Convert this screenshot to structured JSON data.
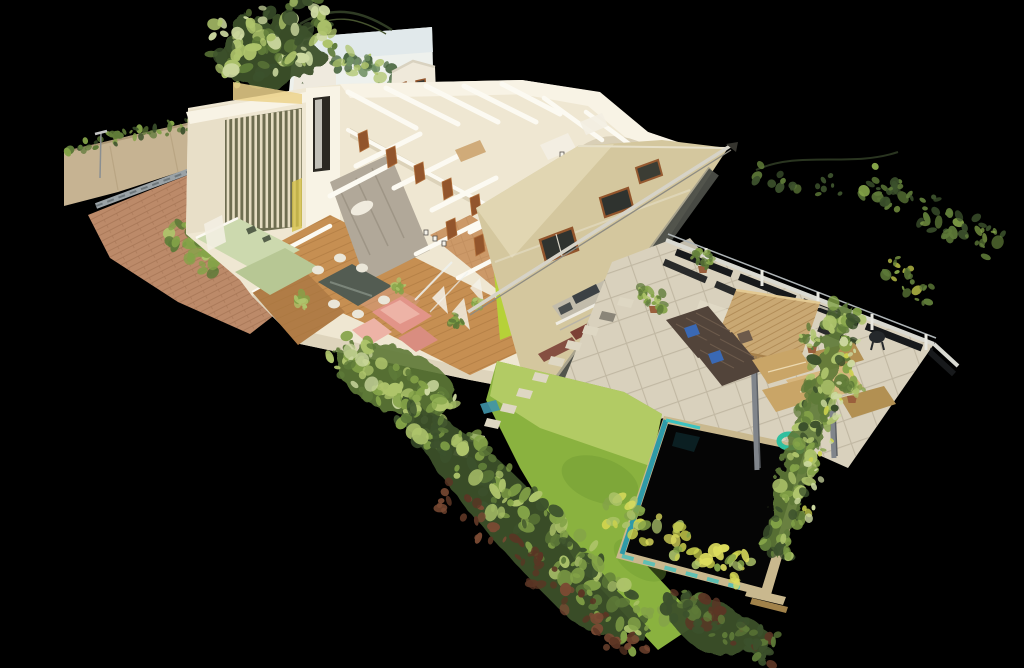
{
  "canvas": {
    "width": 1024,
    "height": 668
  },
  "scene": {
    "type": "3d-dollhouse-point-cloud-render",
    "subject": "cutaway dollhouse view of a single-story house interior with driveway, rear patio, pergola, lawn and swimming pool, surrounded by scan-noise foliage on a black void",
    "view_angle": "oblique top-down isometric"
  },
  "palette": {
    "bg": "#000000",
    "wallCream": "#efe7d2",
    "wallBright": "#f8f3e5",
    "wallShade": "#d9cfb6",
    "wallCap": "#fcfaf2",
    "wallFaceLeft": "#e8dfc8",
    "soffitWarm": "#ecd28c",
    "facadeKhaki": "#d4c79e",
    "facadeKhakiLight": "#e4dab6",
    "facadeEdgeDark": "#4c4e48",
    "facadeTrim": "#e6dfc8",
    "doorBrown": "#92552c",
    "doorBrownLight": "#b06f3a",
    "doorSlitDark": "#2b2822",
    "concreteGray": "#b1a899",
    "concreteDark": "#8e8678",
    "woodFloor": "#c68f52",
    "woodLine": "#a9763d",
    "woodDeck": "#b07c46",
    "tileHall": "#cc9968",
    "roseTile": "#d9a08a",
    "kitchenSage": "#ccd9ae",
    "kitchenSageDark": "#b7c794",
    "applianceDark": "#55604a",
    "sofaPink": "#e29488",
    "sofaPinkLight": "#edb3a6",
    "sofaPinkDeep": "#d98d80",
    "tableDark": "#535c52",
    "tableSheen": "#7b857a",
    "chairWhite": "#eae6d8",
    "limeAccent": "#b6d138",
    "limeDark": "#8fae2a",
    "curtainWhite": "#f4f2ea",
    "slatCream": "#ece2c8",
    "slatGapOlive": "#6e6d50",
    "slatYellow": "#d6c24a",
    "brickDrive": "#bc8a69",
    "brickLine": "#a06f50",
    "channelGray": "#9aa2a6",
    "channelDark": "#6e777b",
    "stoneWall": "#c6b392",
    "stoneWallShade": "#a5916f",
    "poleGray": "#8a8f92",
    "patioTile": "#d9d1bd",
    "patioLine": "#b7ae99",
    "patioLight": "#e5ddca",
    "fenceLight": "#d9d9d1",
    "fenceRailTop": "#aeb4b6",
    "fenceDark": "#17191b",
    "fencePost": "#e8e8e0",
    "pergolaThatch": "#c9a873",
    "pergolaLine": "#a8824c",
    "pergolaEdge": "#e3c992",
    "pergolaPost": "#80858b",
    "pergolaPostDark": "#5c6065",
    "loungerBrown": "#52443a",
    "loungerLight": "#6c5a4b",
    "towelBlue": "#3a69b4",
    "sofaTan": "#c9a567",
    "sofaTanLight": "#d7b67e",
    "sofaTanDark": "#b29052",
    "sofaSeam": "#ecd9b0",
    "potTerracotta": "#9a5f3c",
    "grillDark": "#25282b",
    "lawnMain": "#8ab23f",
    "lawnLight": "#b6cd68",
    "lawnDark": "#6f9a33",
    "stone": "#ded7c3",
    "stoneDark": "#8a8578",
    "poolWater": "#050505",
    "poolReflect": "#123a40",
    "poolTeal": "#2f9aa8",
    "poolTealBright": "#3cc2c0",
    "poolCoping": "#c9b88e",
    "floatTeal": "#2fbf9f",
    "leafDark": "#3c512c",
    "leafMid": "#5e7a38",
    "leafBright": "#84a348",
    "leafLight": "#aec46b",
    "leafPale": "#cdd9a0",
    "frondYellow": "#ccd24e",
    "frondPaleYellow": "#dede5e",
    "dirtRed": "#7a4a33",
    "dirtDark": "#5b3524",
    "panelWhite": "#eef1ed",
    "panelGreen": "#6f8f62",
    "panelGreenDark": "#49663f",
    "skyTint": "#dfe8ea",
    "gableCream": "#efe9da",
    "beamLight": "#d6d3c8",
    "beamShadow": "#8e8c82",
    "terraceBand": "#c2bcab",
    "terracePanel": "#3c4144",
    "terraceSill": "#efece2",
    "planterRed": "#7c4136",
    "benchBrown": "#8a4a30",
    "glassLine": "#eef2f0",
    "bedWood": "#caa06a",
    "closetWhite": "#f3eee2"
  }
}
